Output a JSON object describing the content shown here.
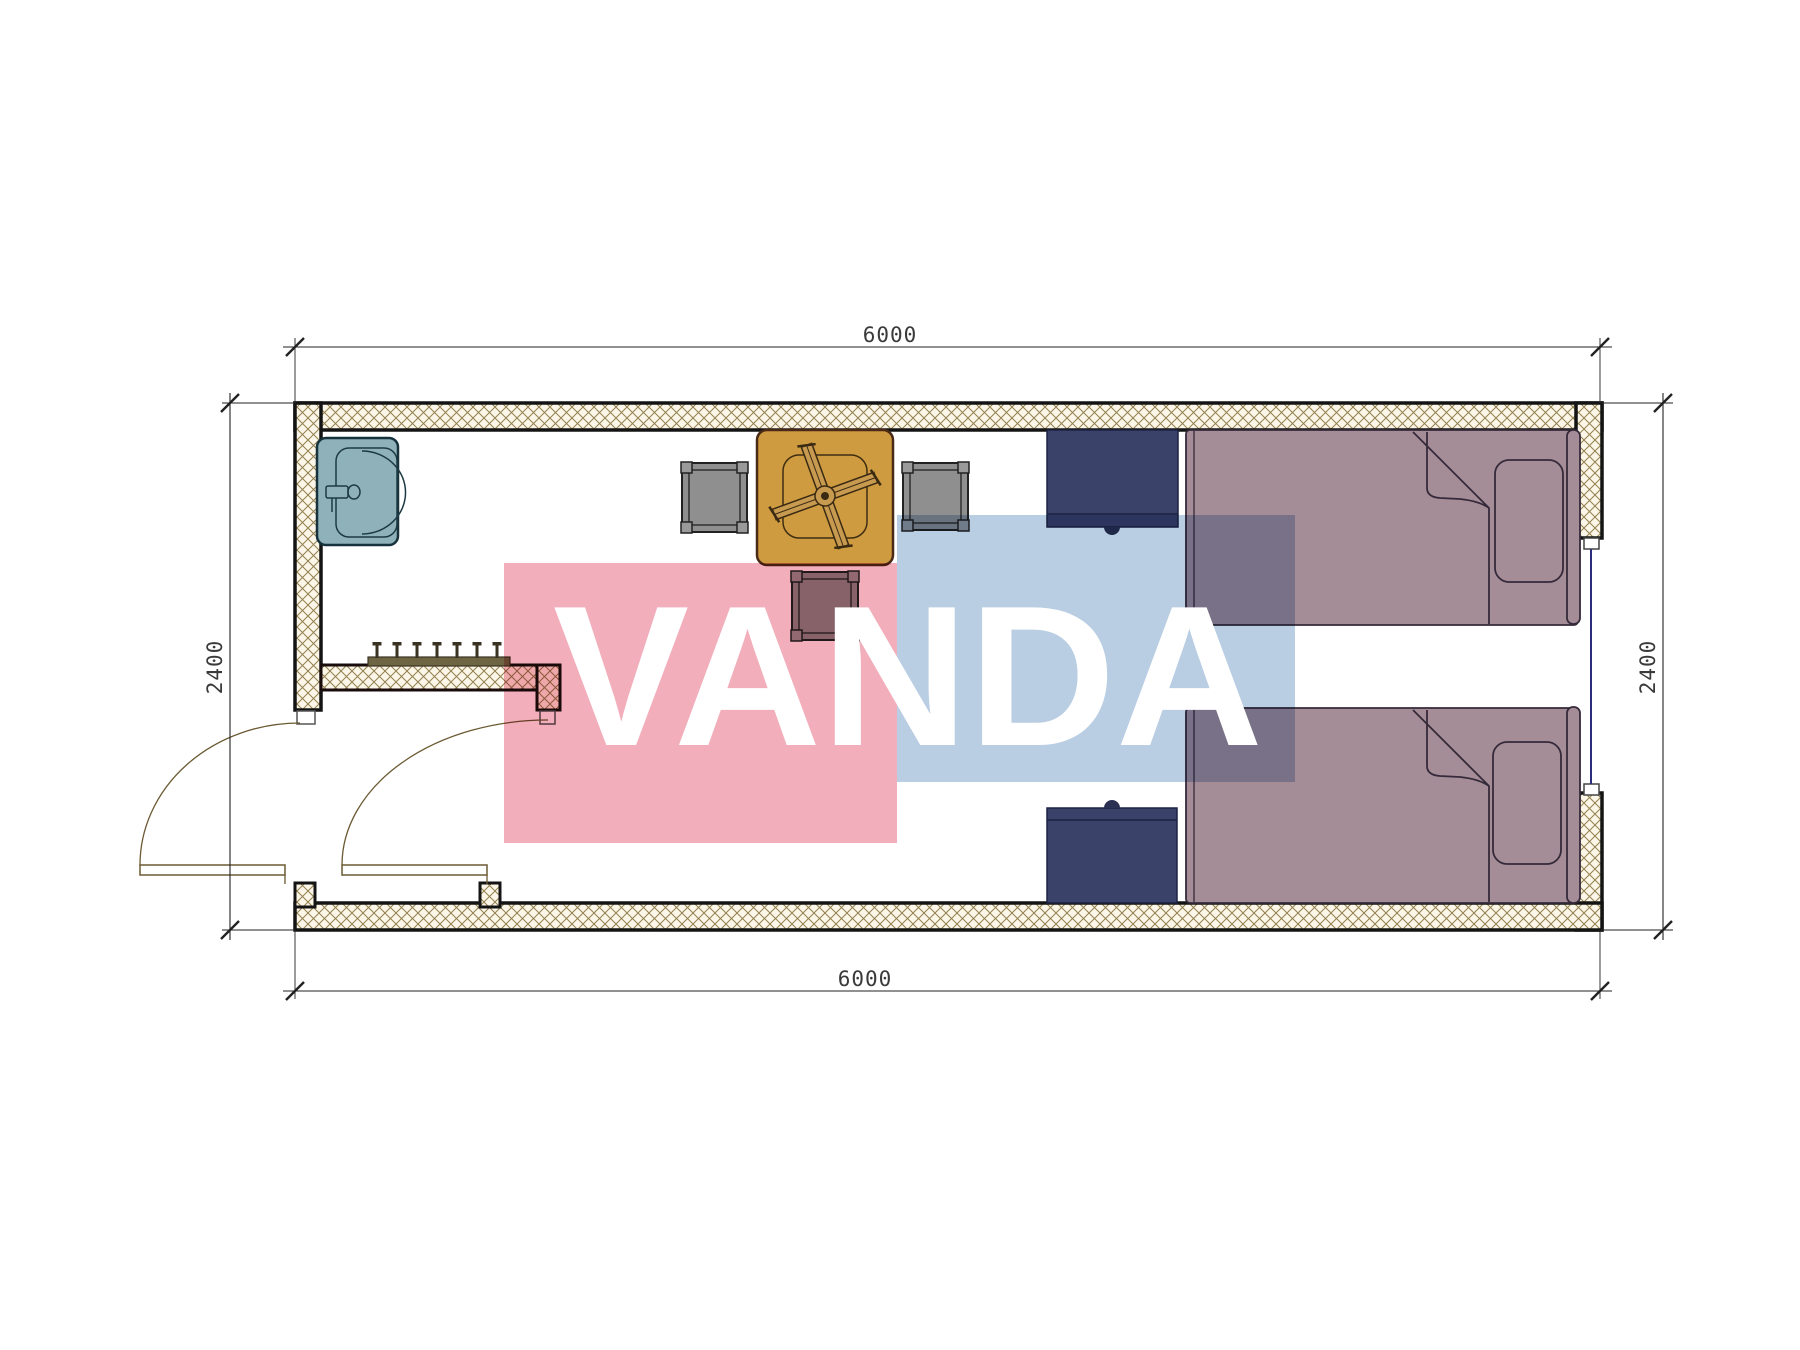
{
  "drawing": {
    "type": "floor-plan",
    "subject": "container room with two single beds, sink, table with ceiling fan symbol, wardrobe rail and two entrance doors"
  },
  "dimensions": {
    "top_width": "6000",
    "bottom_width": "6000",
    "left_height": "2400",
    "right_height": "2400"
  },
  "watermark": {
    "text": "VANDA",
    "pink_color": "#f2aebb",
    "blue_color": "#b9cde3",
    "text_color": "#ffffff"
  },
  "palette": {
    "wall_hatch_line": "#94804f",
    "wall_hatch_bg": "#fbf6e8",
    "wall_outline": "#141414",
    "bed_fill": "#a58d98",
    "bed_line": "#352a3a",
    "nightstand_fill": "#3b4269",
    "nightstand_line": "#1c2342",
    "table_fill": "#cf9b41",
    "table_line": "#4a2a16",
    "chair_fill": "#8f8f8f",
    "chair_line": "#222222",
    "sink_fill": "#8fb1ba",
    "sink_line": "#16323c",
    "door_line": "#6b5a33",
    "window_glass_line": "#2a2d7c",
    "rack_fill": "#6e6543",
    "dim_line": "#222222"
  },
  "furniture": [
    {
      "name": "sink",
      "room_corner": "top-left"
    },
    {
      "name": "wardrobe-rail-with-hooks",
      "position": "interior partition wall"
    },
    {
      "name": "table-with-ceiling-fan-symbol",
      "position": "center-left"
    },
    {
      "name": "chair-left",
      "position": "left of table"
    },
    {
      "name": "chair-right",
      "position": "right of table"
    },
    {
      "name": "chair-bottom",
      "position": "below table"
    },
    {
      "name": "nightstand-top",
      "position": "against top wall"
    },
    {
      "name": "nightstand-bottom",
      "position": "against bottom wall"
    },
    {
      "name": "bed-top",
      "position": "top-right"
    },
    {
      "name": "bed-bottom",
      "position": "bottom-right"
    },
    {
      "name": "door-left",
      "state": "open with swing arc"
    },
    {
      "name": "door-right",
      "state": "open with swing arc"
    },
    {
      "name": "window",
      "position": "right wall"
    }
  ]
}
